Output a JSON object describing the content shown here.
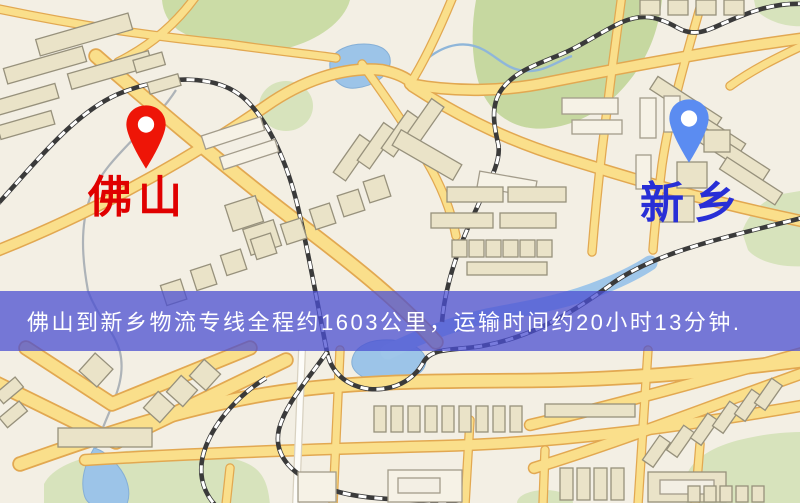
{
  "map": {
    "background_color": "#F3EFE4",
    "road_color": "#FADF8B",
    "road_casing_color": "#E2A851",
    "park_color": "#CBDCA6",
    "water_color": "#9CC4E8",
    "railway_color": "#3A3A3A",
    "markers": [
      {
        "id": "origin",
        "label": "佛山",
        "pin_color": "#EE1507",
        "label_color": "#E00000"
      },
      {
        "id": "destination",
        "label": "新乡",
        "pin_color": "#5B8CF1",
        "label_color": "#282FD6"
      }
    ]
  },
  "banner": {
    "text": "佛山到新乡物流专线全程约1603公里，运输时间约20小时13分钟.",
    "background_color": "rgba(75,79,209,0.75)",
    "text_color": "#FFFFFF"
  },
  "route": {
    "origin": "佛山",
    "destination": "新乡",
    "line_type": "物流专线",
    "distance_text": "约1603公里",
    "duration_text": "约20小时13分钟"
  }
}
